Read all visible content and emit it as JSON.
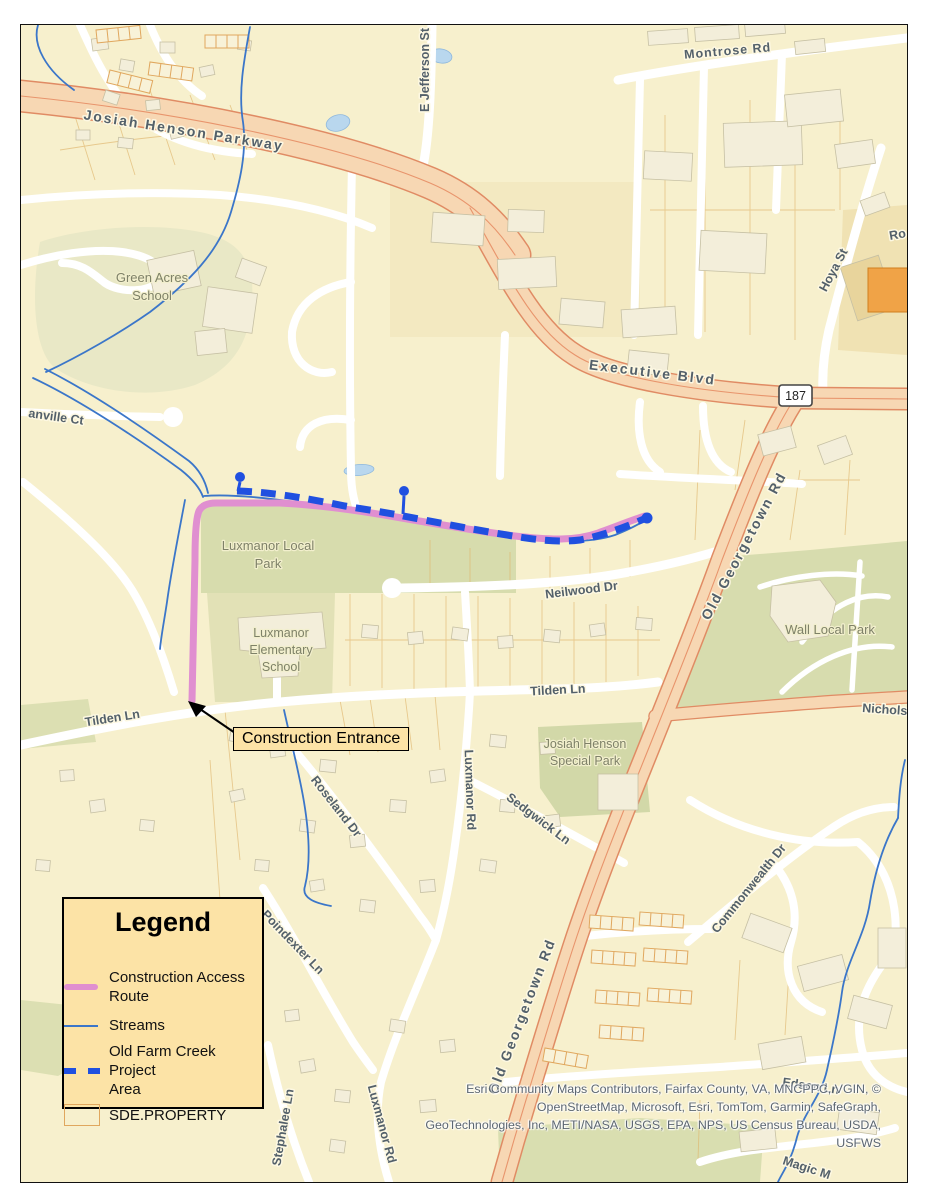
{
  "window": {
    "width": 927,
    "height": 1200,
    "kind": "static GIS map export"
  },
  "map": {
    "background": "#f7f0cd",
    "route_shield": {
      "number": "187"
    },
    "callout": {
      "text": "Construction Entrance"
    },
    "labels": {
      "montrose_rd": "Montrose Rd",
      "josiah_henson_parkway": "Josiah Henson Parkway",
      "e_jefferson_st": "E Jefferson St",
      "executive_blvd": "Executive Blvd",
      "hoya_st": "Hoya St",
      "ro_partial": "Ro",
      "old_georgetown_rd_upper": "Old Georgetown Rd",
      "old_georgetown_rd_lower": "Old Georgetown Rd",
      "green_acres_school_line1": "Green Acres",
      "green_acres_school_line2": "School",
      "anville_ct": "anville Ct",
      "luxmanor_local_park_line1": "Luxmanor Local",
      "luxmanor_local_park_line2": "Park",
      "neilwood_dr": "Neilwood Dr",
      "wall_local_park": "Wall Local Park",
      "luxmanor_elementary_line1": "Luxmanor",
      "luxmanor_elementary_line2": "Elementary",
      "luxmanor_elementary_line3": "School",
      "tilden_ln_west": "Tilden Ln",
      "tilden_ln_east": "Tilden Ln",
      "nicholson_ln": "Nicholson Ln",
      "josiah_henson_special_park_line1": "Josiah Henson",
      "josiah_henson_special_park_line2": "Special Park",
      "roseland_dr": "Roseland Dr",
      "luxmanor_rd_mid": "Luxmanor Rd",
      "sedgwick_ln": "Sedgwick Ln",
      "commonwealth_dr": "Commonwealth Dr",
      "poindexter_ln": "Poindexter Ln",
      "stephalee_ln": "Stephalee Ln",
      "luxmanor_rd_south": "Luxmanor Rd",
      "edson_ln": "Edson Ln",
      "magic_partial": "Magic M"
    },
    "legend": {
      "title": "Legend",
      "items": [
        {
          "line1": "Construction Access",
          "line2": "Route",
          "symbol": "construction-access-route-line",
          "color": "#e08fd0"
        },
        {
          "line1": "Streams",
          "line2": "",
          "symbol": "stream-line",
          "color": "#3b76c9"
        },
        {
          "line1": "Old Farm Creek Project",
          "line2": "Area",
          "symbol": "project-area-dashed-line",
          "color": "#2050e0"
        },
        {
          "line1": "SDE.PROPERTY",
          "line2": "",
          "symbol": "parcel-outline",
          "color": "#e0a75e"
        }
      ]
    },
    "attribution": {
      "lines": [
        "Esri Community Maps Contributors, Fairfax County, VA, MNCPPC, VGIN, ©",
        "OpenStreetMap, Microsoft, Esri, TomTom, Garmin, SafeGraph,",
        "GeoTechnologies, Inc, METI/NASA, USGS, EPA, NPS, US Census Bureau, USDA,",
        "USFWS"
      ]
    },
    "colors": {
      "map_background": "#f7f0cd",
      "park_green": "#d7dcad",
      "water_blue": "#b9d7ee",
      "stream_blue": "#3b76c9",
      "major_road_fill": "#f7d7b3",
      "major_road_casing": "#e08b64",
      "construction_route_pink": "#e08fd0",
      "project_area_blue": "#2050e0",
      "parcel_orange": "#e0a75e",
      "legend_fill": "#fce3a6",
      "road_label_gray": "#53606a",
      "park_label_gray": "#7e8168"
    }
  }
}
